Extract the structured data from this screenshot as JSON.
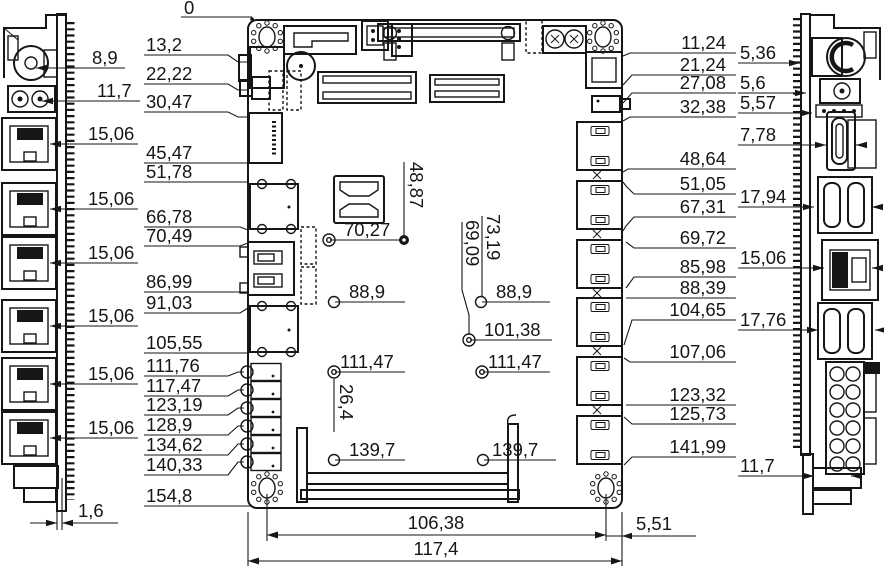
{
  "drawing": {
    "type": "mechanical-dimension-drawing",
    "background": "#ffffff",
    "ink": "#161616",
    "origin_label": "0",
    "left_col": [
      "13,2",
      "22,22",
      "30,47",
      "45,47",
      "51,78",
      "66,78",
      "70,49",
      "86,99",
      "91,03",
      "105,55",
      "111,76",
      "117,47",
      "123,19",
      "128,9",
      "134,62",
      "140,33",
      "154,8"
    ],
    "far_left": [
      "8,9",
      "11,7",
      "15,06",
      "15,06",
      "15,06",
      "15,06",
      "15,06",
      "15,06",
      "1,6"
    ],
    "right_col": [
      "11,24",
      "21,24",
      "27,08",
      "32,38",
      "48,64",
      "51,05",
      "67,31",
      "69,72",
      "85,98",
      "88,39",
      "104,65",
      "107,06",
      "123,32",
      "125,73",
      "141,99"
    ],
    "far_right": [
      "5,36",
      "5,6",
      "5,57",
      "7,78",
      "17,94",
      "15,06",
      "17,76",
      "11,7"
    ],
    "center": [
      "48,87",
      "70,27",
      "88,9",
      "73,19",
      "69,09",
      "88,9",
      "101,38",
      "111,47",
      "111,47",
      "26,4",
      "139,7",
      "139,7"
    ],
    "bottom": [
      "106,38",
      "117,4",
      "5,51"
    ]
  }
}
